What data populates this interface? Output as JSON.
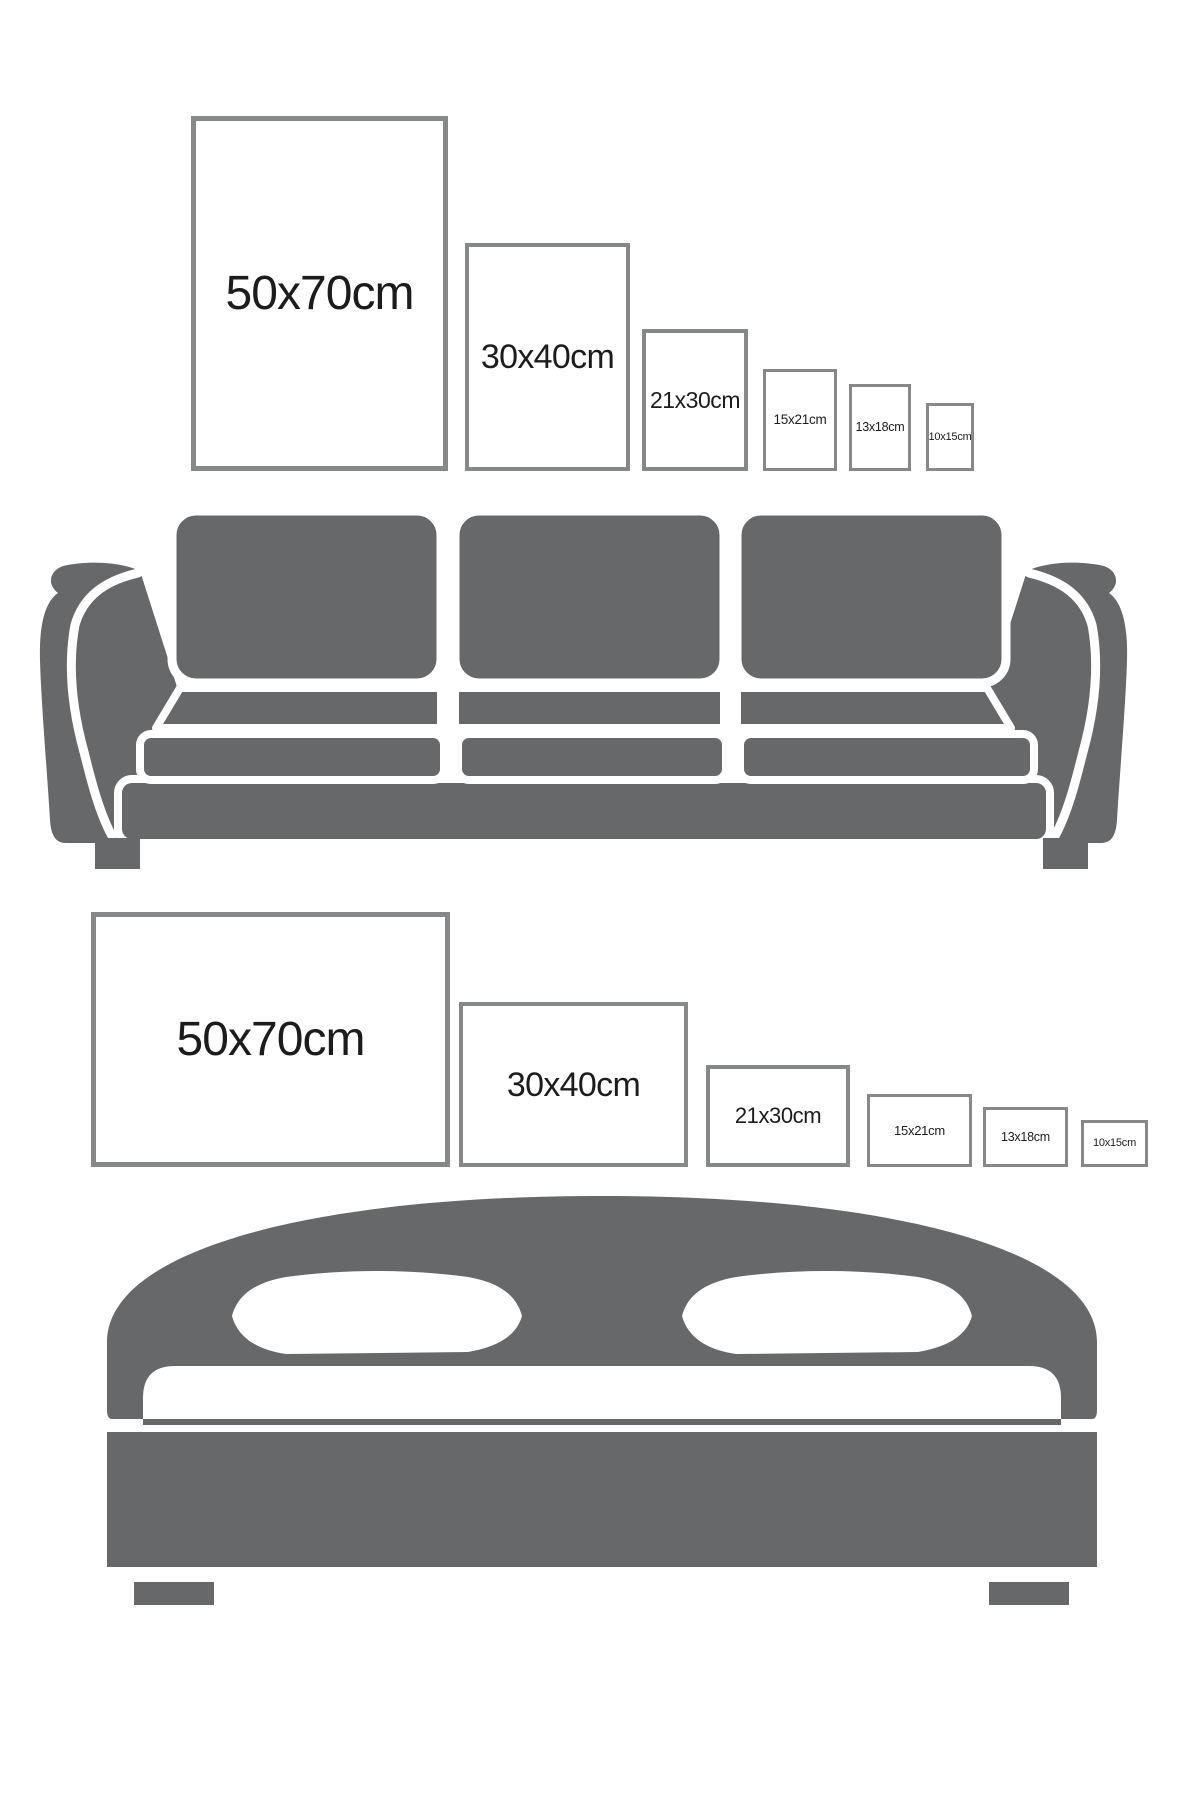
{
  "colors": {
    "background": "#ffffff",
    "furniture": "#67686a",
    "frame_border": "#87888a",
    "frame_fill": "#ffffff",
    "label": "#1c1c1c"
  },
  "diagram_title": "",
  "size_labels": [
    "50x70cm",
    "30x40cm",
    "21x30cm",
    "15x21cm",
    "13x18cm",
    "10x15cm"
  ],
  "sections": [
    {
      "name": "portrait-sizes-above-sofa",
      "furniture": "sofa",
      "frames": [
        {
          "label": "50x70cm",
          "x": 191,
          "y": 116,
          "w": 257,
          "h": 355,
          "border": 5,
          "font": 48
        },
        {
          "label": "30x40cm",
          "x": 465,
          "y": 243,
          "w": 165,
          "h": 228,
          "border": 4,
          "font": 34
        },
        {
          "label": "21x30cm",
          "x": 642,
          "y": 329,
          "w": 106,
          "h": 142,
          "border": 4,
          "font": 23
        },
        {
          "label": "15x21cm",
          "x": 763,
          "y": 369,
          "w": 74,
          "h": 102,
          "border": 3,
          "font": 13.5
        },
        {
          "label": "13x18cm",
          "x": 849,
          "y": 384,
          "w": 62,
          "h": 87,
          "border": 3,
          "font": 12.5
        },
        {
          "label": "10x15cm",
          "x": 926,
          "y": 403,
          "w": 48,
          "h": 68,
          "border": 3,
          "font": 11
        }
      ]
    },
    {
      "name": "landscape-sizes-above-bed",
      "furniture": "bed",
      "frames": [
        {
          "label": "50x70cm",
          "x": 91,
          "y": 912,
          "w": 359,
          "h": 255,
          "border": 5,
          "font": 48
        },
        {
          "label": "30x40cm",
          "x": 459,
          "y": 1002,
          "w": 229,
          "h": 165,
          "border": 4,
          "font": 34
        },
        {
          "label": "21x30cm",
          "x": 706,
          "y": 1065,
          "w": 144,
          "h": 102,
          "border": 4,
          "font": 22
        },
        {
          "label": "15x21cm",
          "x": 867,
          "y": 1094,
          "w": 105,
          "h": 73,
          "border": 3,
          "font": 13
        },
        {
          "label": "13x18cm",
          "x": 983,
          "y": 1107,
          "w": 85,
          "h": 60,
          "border": 3,
          "font": 12.5
        },
        {
          "label": "10x15cm",
          "x": 1081,
          "y": 1120,
          "w": 67,
          "h": 47,
          "border": 3,
          "font": 11
        }
      ]
    }
  ]
}
